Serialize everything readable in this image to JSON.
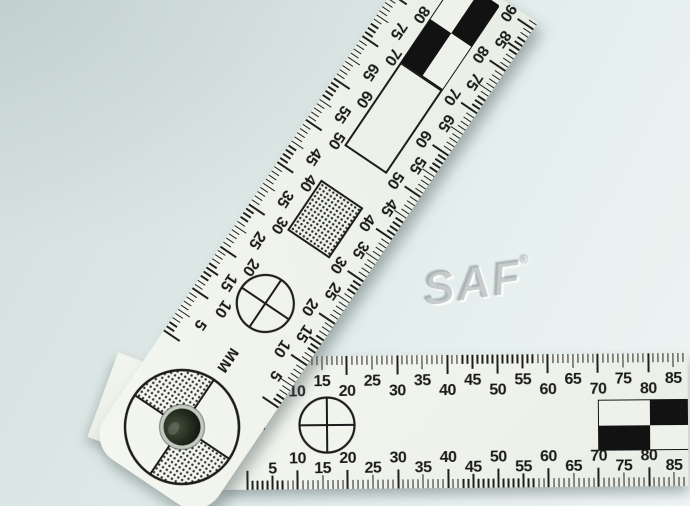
{
  "watermark": {
    "text": "SAF",
    "registered_mark": "®"
  },
  "colors": {
    "ink": "#1f1f1f",
    "checker_black": "#121212",
    "ruler_body": "#eef2ea",
    "background_top": "#d2dedd",
    "background_bottom": "#eef5f4",
    "rivet_dark": "#1c2318",
    "rivet_rim": "#c3cabf"
  },
  "horizontal_ruler": {
    "unit_label": "MM",
    "tick_interval_mm": 1,
    "number_interval_mm": 5,
    "top_scale_numbers": [
      10,
      15,
      20,
      25,
      30,
      35,
      40,
      45,
      50,
      55,
      60,
      65,
      70,
      75,
      80,
      85
    ],
    "bottom_scale_numbers": [
      5,
      10,
      15,
      20,
      25,
      30,
      35,
      40,
      45,
      50,
      55,
      60,
      65,
      70,
      75,
      80,
      85
    ],
    "crosshair_center_mm": 15.7,
    "checker": {
      "start_mm": 70,
      "end_mm": 90,
      "cell_mm": 10,
      "rows": [
        [
          "white",
          "black"
        ],
        [
          "black",
          "white"
        ]
      ]
    }
  },
  "diagonal_ruler": {
    "unit_label": "MM",
    "angle_deg": -56,
    "left_scale_numbers": [
      5,
      10,
      15,
      20,
      25,
      30,
      35,
      40,
      45,
      50,
      55,
      60,
      65,
      70,
      75,
      80
    ],
    "right_scale_numbers": [
      5,
      10,
      15,
      20,
      25,
      30,
      35,
      40,
      45,
      50,
      55,
      60,
      65,
      70,
      75,
      80,
      85,
      90
    ],
    "crosshair_center_mm": 15.6,
    "dotted_rectangle_mm": {
      "start": 30,
      "end": 42
    },
    "outlined_rectangle_mm": {
      "start": 50,
      "end": 70
    },
    "checker": {
      "start_mm": 70,
      "end_mm": 90,
      "cell_mm": 10,
      "rows": [
        [
          "black",
          "white"
        ],
        [
          "white",
          "black"
        ]
      ]
    }
  }
}
